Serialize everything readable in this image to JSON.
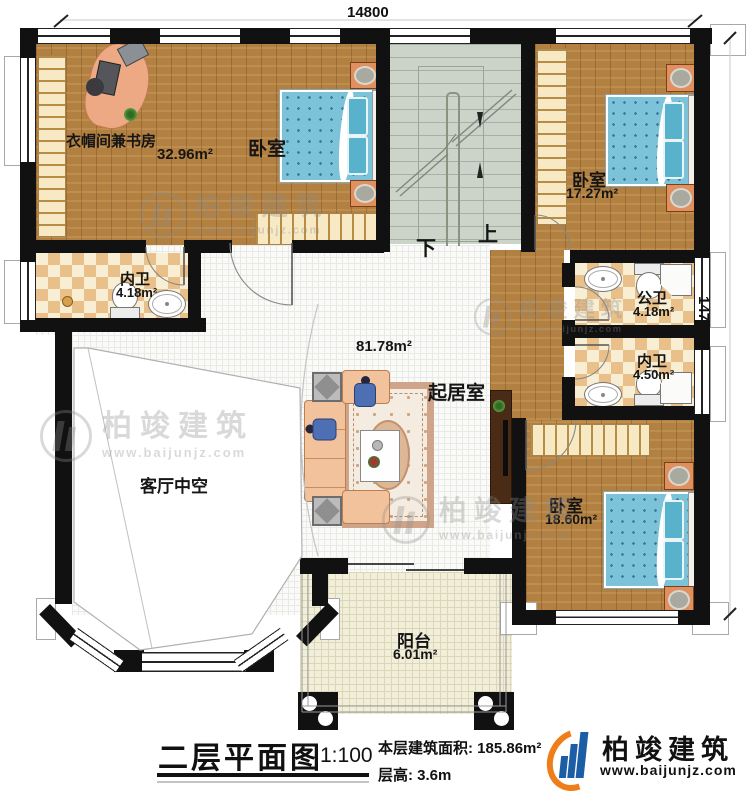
{
  "plan": {
    "dim_top": "14800",
    "dim_right": "14700",
    "stair_down": "下",
    "stair_up": "上",
    "rooms": {
      "study": {
        "label": "衣帽间兼书房",
        "area": "32.96m²"
      },
      "bedroom_tl": {
        "label": "卧室"
      },
      "bedroom_tr": {
        "label": "卧室",
        "area": "17.27m²"
      },
      "bath_left": {
        "label": "内卫",
        "area": "4.18m²"
      },
      "bath_public": {
        "label": "公卫",
        "area": "4.18m²"
      },
      "bath_right": {
        "label": "内卫",
        "area": "4.50m²"
      },
      "living": {
        "label": "起居室",
        "area": "81.78m²"
      },
      "void": {
        "label": "客厅中空"
      },
      "bedroom_br": {
        "label": "卧室",
        "area": "18.60m²"
      },
      "balcony": {
        "label": "阳台",
        "area": "6.01m²"
      }
    }
  },
  "titleblock": {
    "title": "二层平面图",
    "scale": "1:100",
    "area_label": "本层建筑面积:",
    "area_value": "185.86m²",
    "floor_height_label": "层高:",
    "floor_height_value": "3.6m"
  },
  "brand": {
    "name": "柏竣建筑",
    "url": "www.baijunjz.com"
  },
  "watermark": {
    "name": "柏竣建筑",
    "url": "www.baijunjz.com"
  },
  "colors": {
    "wall": "#111111",
    "wood": "#b28041",
    "stair": "#ccd4ca",
    "checker_dark": "#e9c089",
    "checker_light": "#f8eed3",
    "bed_blue": "#7cc2d8",
    "sofa_salmon": "#f1c29c",
    "brand_blue": "#1b5ea6",
    "brand_orange": "#ee7d1a"
  }
}
